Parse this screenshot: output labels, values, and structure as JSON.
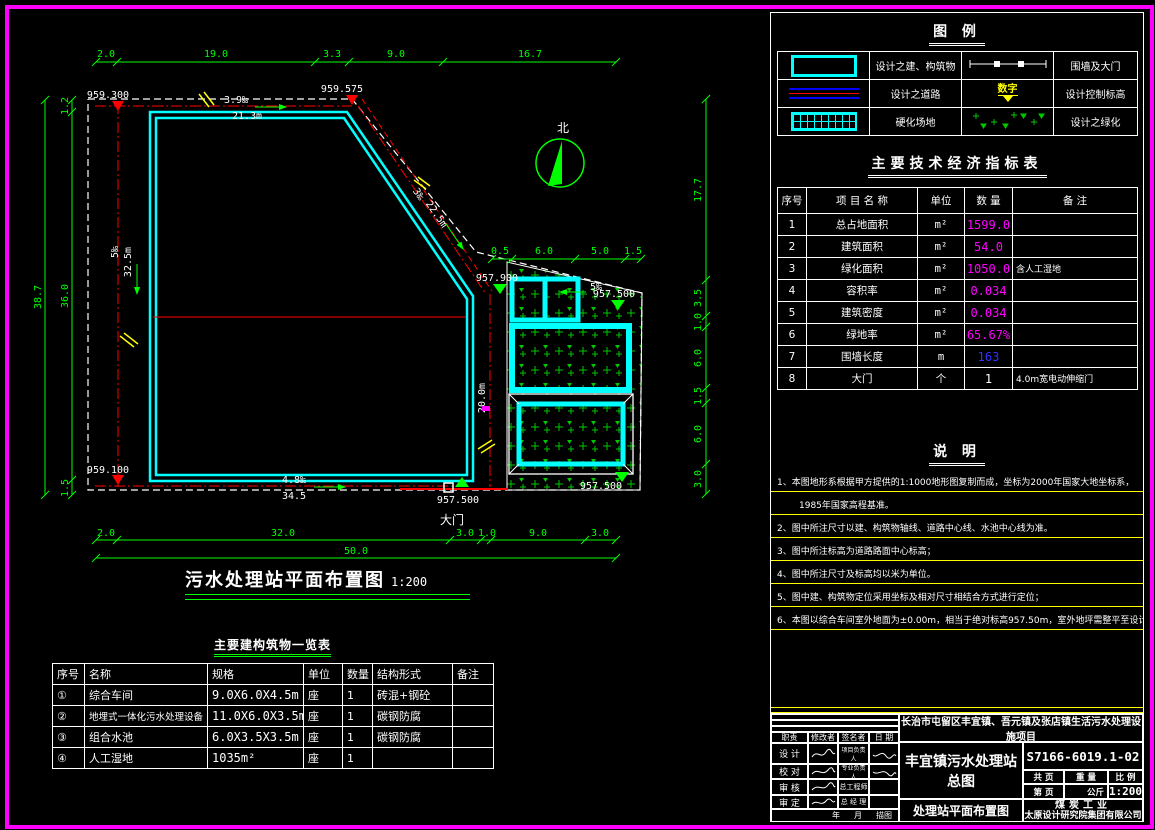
{
  "legend": {
    "title": "图  例",
    "items": [
      {
        "symbol": "building-outline",
        "label": "设计之建、构筑物"
      },
      {
        "symbol": "wall-gate-line",
        "label": "围墙及大门"
      },
      {
        "symbol": "road-lines",
        "label": "设计之道路"
      },
      {
        "symbol": "elevation-marker",
        "label": "设计控制标高",
        "symbol_text": "数字"
      },
      {
        "symbol": "hardened-grid",
        "label": "硬化场地"
      },
      {
        "symbol": "greenery-dots",
        "label": "设计之绿化"
      }
    ]
  },
  "indicators": {
    "title": "主要技术经济指标表",
    "headers": [
      "序号",
      "项 目 名 称",
      "单位",
      "数 量",
      "备  注"
    ],
    "rows": [
      {
        "no": "1",
        "name": "总占地面积",
        "unit": "m²",
        "qty": "1599.0",
        "note": ""
      },
      {
        "no": "2",
        "name": "建筑面积",
        "unit": "m²",
        "qty": "54.0",
        "note": ""
      },
      {
        "no": "3",
        "name": "绿化面积",
        "unit": "m²",
        "qty": "1050.0",
        "note": "含人工湿地"
      },
      {
        "no": "4",
        "name": "容积率",
        "unit": "m²",
        "qty": "0.034",
        "note": ""
      },
      {
        "no": "5",
        "name": "建筑密度",
        "unit": "m²",
        "qty": "0.034",
        "note": ""
      },
      {
        "no": "6",
        "name": "绿地率",
        "unit": "m²",
        "qty": "65.67%",
        "note": ""
      },
      {
        "no": "7",
        "name": "围墙长度",
        "unit": "m",
        "qty": "163",
        "note": ""
      },
      {
        "no": "8",
        "name": "大门",
        "unit": "个",
        "qty": "1",
        "note": "4.0m宽电动伸缩门"
      }
    ]
  },
  "notes": {
    "title": "说  明",
    "lines": [
      "1、本图地形系根据甲方提供的1:1000地形图复制而成，坐标为2000年国家大地坐标系，",
      "1985年国家高程基准。",
      "2、图中所注尺寸以建、构筑物轴线、道路中心线、水池中心线为准。",
      "3、图中所注标高为道路路面中心标高；",
      "4、图中所注尺寸及标高均以米为单位。",
      "5、图中建、构筑物定位采用坐标及相对尺寸相结合方式进行定位；",
      "6、本图以综合车间室外地面为±0.00m，相当于绝对标高957.50m，室外地坪需整平至设计标高。"
    ]
  },
  "title_block": {
    "project": "长治市屯留区丰宜镇、吾元镇及张店镇生活污水处理设施项目",
    "station_line1": "丰宜镇污水处理站",
    "station_line2": "总图",
    "drawing_name": "处理站平面布置图",
    "drawing_no": "S7166-6019.1-02",
    "pages_label": "共  页",
    "weight_label": "重  量",
    "scale_label": "比  例",
    "page_label": "第  页",
    "kg_label": "公斤",
    "scale": "1:200",
    "company_line1": "煤炭工业",
    "company_line2": "太原设计研究院集团有限公司",
    "sig_headers": [
      "职责",
      "修改者",
      "签名者",
      "日 期"
    ],
    "roles": [
      "设 计",
      "校 对",
      "审 核",
      "审 定"
    ],
    "roles2": [
      "项目负责人",
      "专业负责人",
      "总工程师",
      "总 经 理"
    ],
    "footer": [
      "年",
      "月",
      "描图"
    ]
  },
  "structures": {
    "title": "主要建构筑物一览表",
    "headers": [
      "序号",
      "名称",
      "规格",
      "单位",
      "数量",
      "结构形式",
      "备注"
    ],
    "rows": [
      {
        "no": "①",
        "name": "综合车间",
        "spec": "9.0X6.0X4.5m",
        "unit": "座",
        "qty": "1",
        "struct": "砖混+钢砼",
        "note": ""
      },
      {
        "no": "②",
        "name": "地埋式一体化污水处理设备",
        "spec": "11.0X6.0X3.5m",
        "unit": "座",
        "qty": "1",
        "struct": "碳钢防腐",
        "note": ""
      },
      {
        "no": "③",
        "name": "组合水池",
        "spec": "6.0X3.5X3.5m",
        "unit": "座",
        "qty": "1",
        "struct": "碳钢防腐",
        "note": ""
      },
      {
        "no": "④",
        "name": "人工湿地",
        "spec": "1035m²",
        "unit": "座",
        "qty": "1",
        "struct": "",
        "note": ""
      }
    ]
  },
  "plan": {
    "title": "污水处理站平面布置图",
    "scale": "1:200",
    "north": "北",
    "gate": "大门",
    "elev": {
      "tl": "959.300",
      "tr": "959.575",
      "bl": "959.100",
      "gate": "957.500",
      "mid": "957.900",
      "ur": "957.500",
      "br": "957.500"
    },
    "ann": {
      "top_slope": "3.9‰",
      "top_len": "21.3m",
      "left_slope": "5‰",
      "left_len": "32.5m",
      "diag_slope": "3‰",
      "diag_len": "22.5m",
      "gate_len": "20.0m",
      "bottom_slope": "4.8‰",
      "bottom_len": "34.5",
      "right_slope": "5‰"
    },
    "dims": {
      "top": [
        "2.0",
        "19.0",
        "3.3",
        "9.0",
        "16.7"
      ],
      "bottom": [
        "2.0",
        "32.0",
        "3.0",
        "1.0",
        "9.0",
        "3.0"
      ],
      "bottom_total": "50.0",
      "left": [
        "1.2",
        "36.0",
        "1.5"
      ],
      "left_total": "38.7",
      "right": [
        "17.7",
        "3.5",
        "1.0",
        "6.0",
        "1.5",
        "6.0",
        "3.0"
      ],
      "inner_top": [
        "0.5",
        "6.0",
        "5.0",
        "1.5"
      ]
    }
  }
}
